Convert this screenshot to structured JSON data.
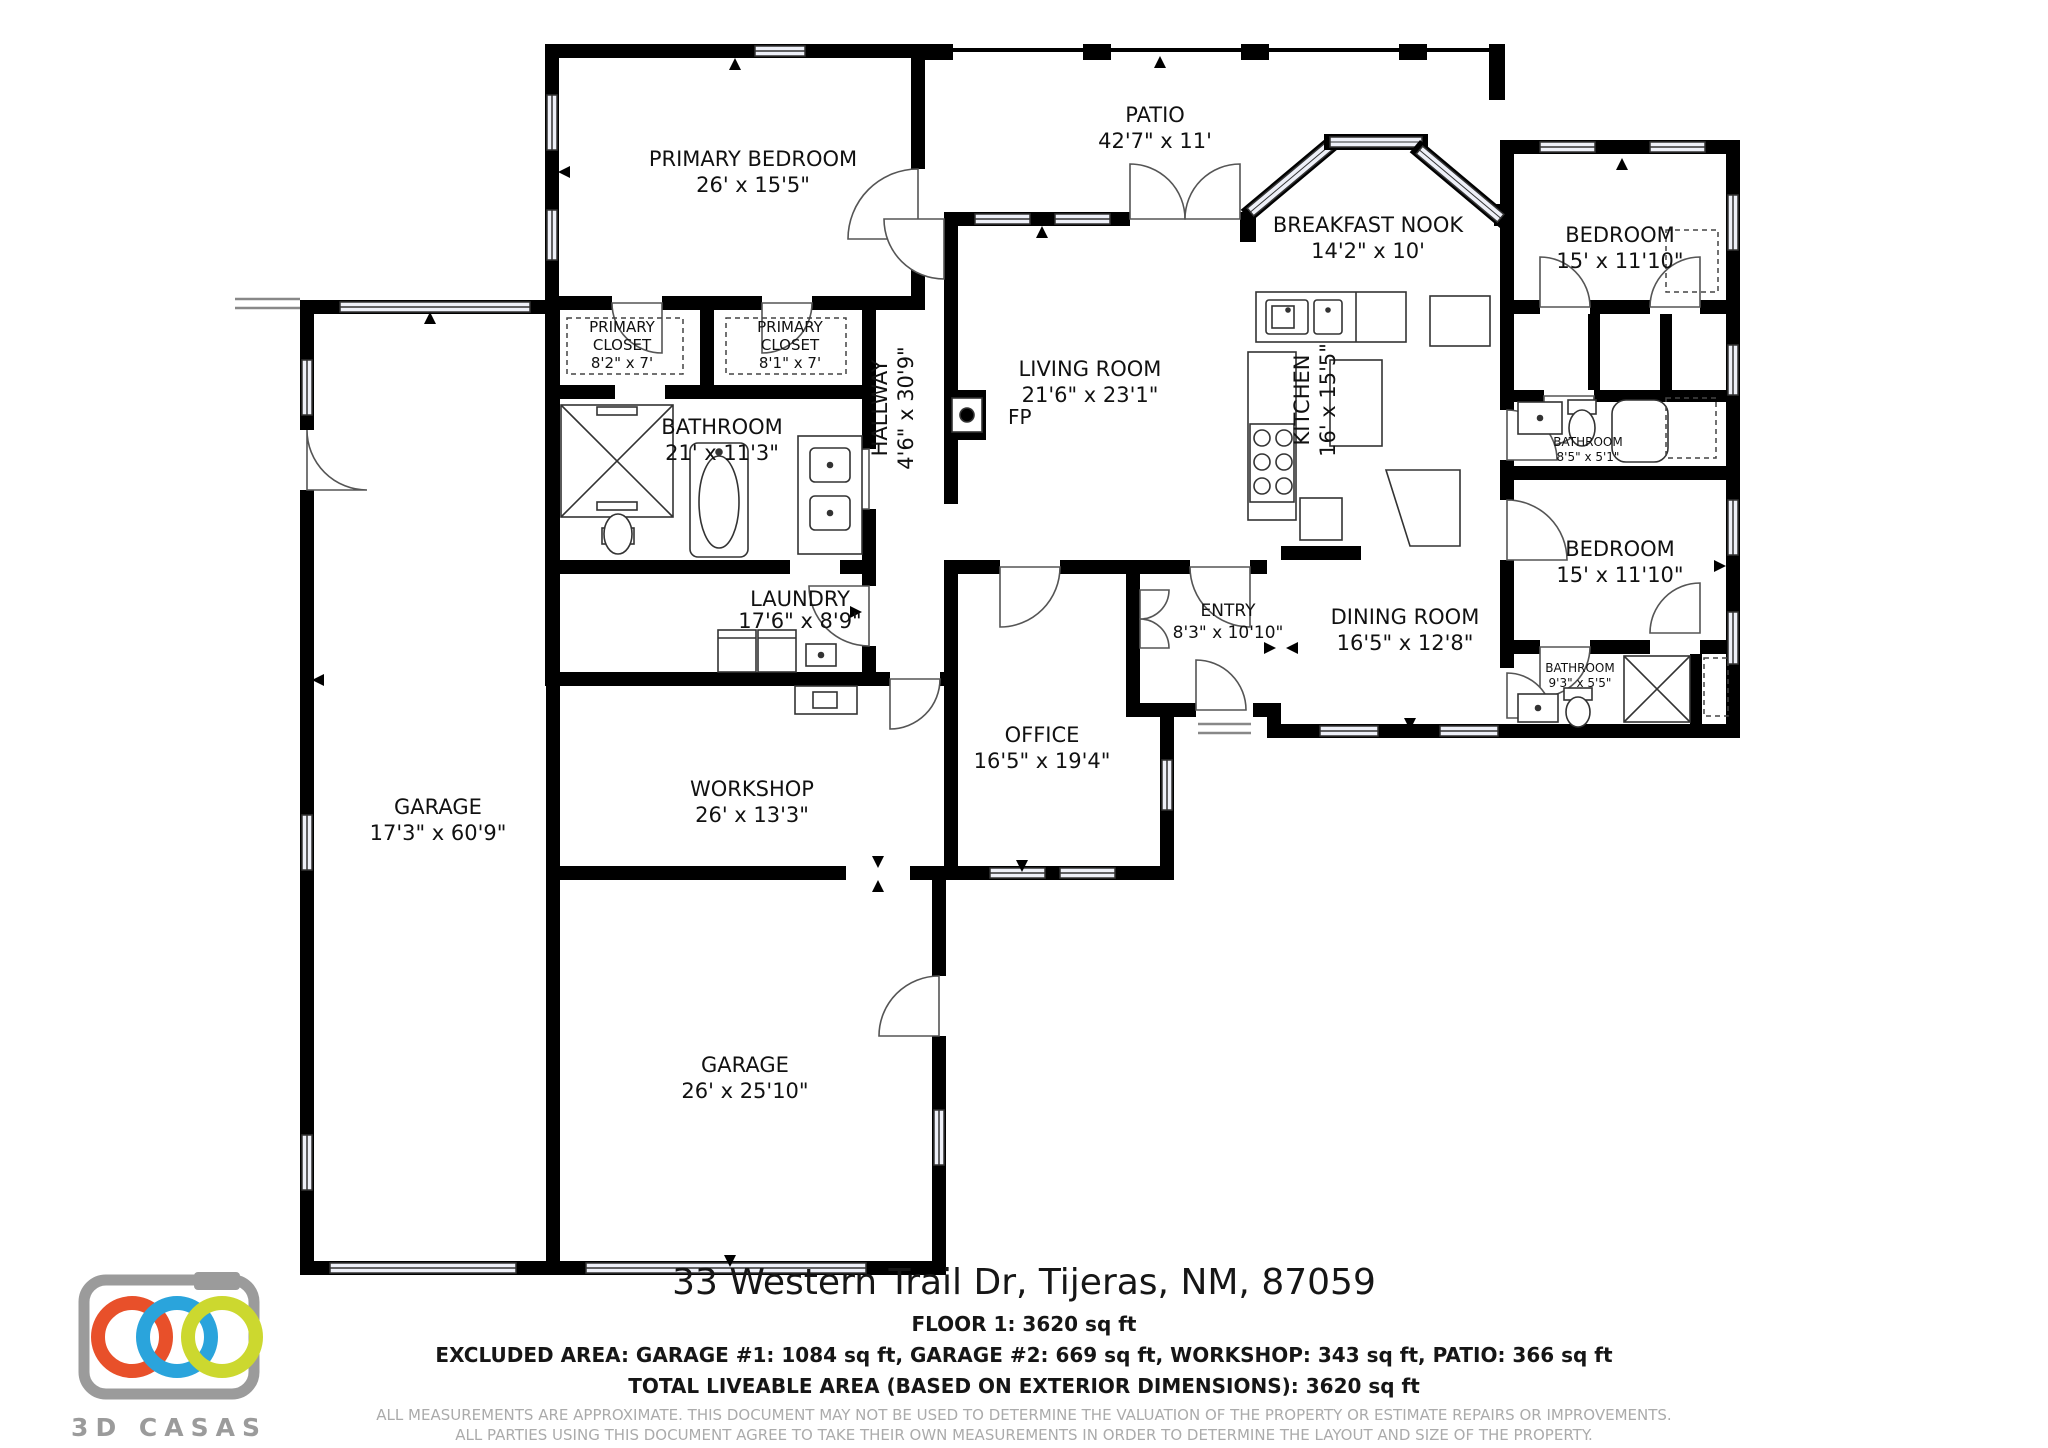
{
  "floorplan": {
    "rooms": [
      {
        "id": "primary-bedroom",
        "name": "PRIMARY BEDROOM",
        "dims": "26' x 15'5\""
      },
      {
        "id": "patio",
        "name": "PATIO",
        "dims": "42'7\" x 11'"
      },
      {
        "id": "breakfast-nook",
        "name": "BREAKFAST NOOK",
        "dims": "14'2\" x 10'"
      },
      {
        "id": "bedroom-top-right",
        "name": "BEDROOM",
        "dims": "15' x 11'10\""
      },
      {
        "id": "primary-closet-1",
        "name": "PRIMARY",
        "name2": "CLOSET",
        "dims": "8'2\" x 7'"
      },
      {
        "id": "primary-closet-2",
        "name": "PRIMARY",
        "name2": "CLOSET",
        "dims": "8'1\" x 7'"
      },
      {
        "id": "bathroom-primary",
        "name": "BATHROOM",
        "dims": "21' x 11'3\""
      },
      {
        "id": "hallway",
        "name": "HALLWAY",
        "dims": "4'6\" x 30'9\""
      },
      {
        "id": "living-room",
        "name": "LIVING ROOM",
        "dims": "21'6\" x 23'1\""
      },
      {
        "id": "kitchen",
        "name": "KITCHEN",
        "dims": "16' x 15'5\""
      },
      {
        "id": "bathroom-upper-right",
        "name": "BATHROOM",
        "dims": "8'5\" x 5'1\""
      },
      {
        "id": "bedroom-right",
        "name": "BEDROOM",
        "dims": "15' x 11'10\""
      },
      {
        "id": "laundry",
        "name": "LAUNDRY",
        "dims": "17'6\" x 8'9\""
      },
      {
        "id": "entry",
        "name": "ENTRY",
        "dims": "8'3\" x 10'10\""
      },
      {
        "id": "dining-room",
        "name": "DINING ROOM",
        "dims": "16'5\" x 12'8\""
      },
      {
        "id": "bathroom-lower-right",
        "name": "BATHROOM",
        "dims": "9'3\" x 5'5\""
      },
      {
        "id": "office",
        "name": "OFFICE",
        "dims": "16'5\" x 19'4\""
      },
      {
        "id": "garage-side",
        "name": "GARAGE",
        "dims": "17'3\" x 60'9\""
      },
      {
        "id": "workshop",
        "name": "WORKSHOP",
        "dims": "26' x 13'3\""
      },
      {
        "id": "garage-main",
        "name": "GARAGE",
        "dims": "26' x 25'10\""
      }
    ],
    "fireplace_label": "FP"
  },
  "footer": {
    "address": "33 Western Trail Dr, Tijeras, NM, 87059",
    "floor_line": "FLOOR 1: 3620 sq ft",
    "excluded_line": "EXCLUDED AREA: GARAGE #1: 1084 sq ft, GARAGE #2: 669 sq ft, WORKSHOP: 343 sq ft, PATIO: 366 sq ft",
    "total_line": "TOTAL LIVEABLE AREA (BASED ON EXTERIOR DIMENSIONS): 3620 sq ft",
    "disclaimer_line1": "ALL MEASUREMENTS ARE APPROXIMATE. THIS DOCUMENT MAY NOT BE USED TO DETERMINE THE VALUATION OF THE PROPERTY OR ESTIMATE REPAIRS OR IMPROVEMENTS.",
    "disclaimer_line2": "ALL PARTIES USING THIS DOCUMENT AGREE TO TAKE THEIR OWN MEASUREMENTS IN ORDER TO DETERMINE THE LAYOUT AND SIZE OF THE PROPERTY."
  },
  "logo": {
    "brand": "3D CASAS",
    "colors": {
      "camera_gray": "#9b9b9b",
      "ring_orange": "#e8502a",
      "ring_blue": "#2aa4dc",
      "ring_yellow": "#ccd82f"
    }
  }
}
